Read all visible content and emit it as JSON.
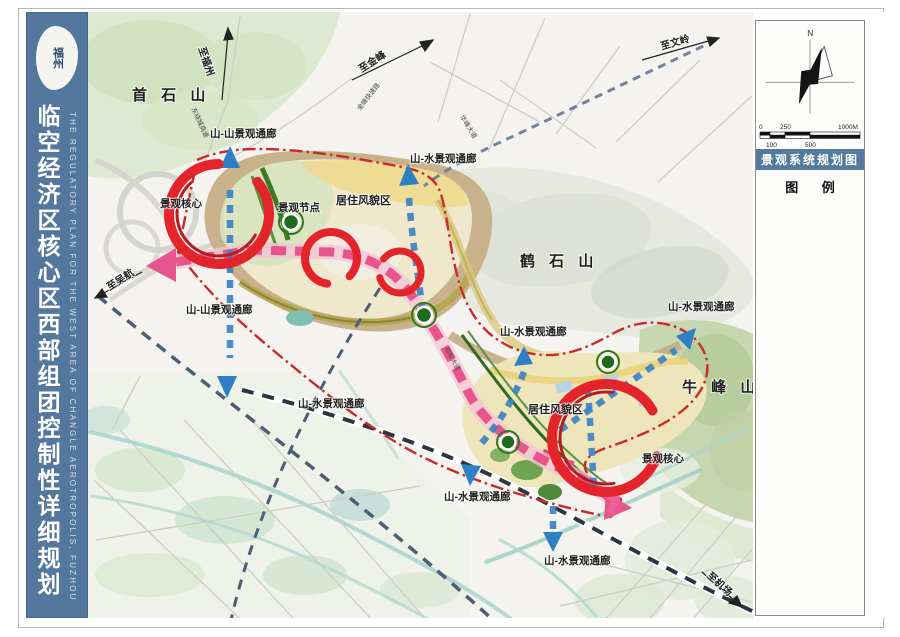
{
  "sidebar": {
    "accent": "#54779e",
    "title": "临空经济区核心区西部组团控制性详细规划",
    "subtitle_en": "THE REGULATORY PLAN FOR THE WEST AREA OF CHANGLE AEROTROPOLIS, FUZHOU",
    "seal_text": "福州"
  },
  "panel": {
    "north_label": "N",
    "map_title": "景观系统规划图",
    "legend_title": "图 例",
    "scale_ticks": {
      "t0": "0",
      "t100": "100",
      "t250": "250",
      "t500": "500",
      "t1000": "1000M"
    }
  },
  "map": {
    "mountains": {
      "shoushi": "首 石 山",
      "heshi": "鹤 石 山",
      "niufeng": "牛 峰 山"
    },
    "corridors": {
      "ss_top": "山-山景观通廊",
      "ss_mid": "山-山景观通廊",
      "sw_top": "山-水景观通廊",
      "sw_heshi": "山-水景观通廊",
      "sw_right": "山-水景观通廊",
      "sw_left": "山-水景观通廊",
      "sw_center": "山-水景观通廊",
      "sw_bottom": "山-水景观通廊"
    },
    "nodes": {
      "node_label": "景观节点",
      "core_nw": "景观核心",
      "core_se": "景观核心"
    },
    "areas": {
      "residential_nw": "居住风貌区",
      "residential_se": "居住风貌区"
    },
    "destinations": {
      "fuzhou": "至福州",
      "jinfeng": "至金峰",
      "wenling": "至文岭",
      "wuhang": "至吴航",
      "airport": "至机场"
    },
    "roads": {
      "raocheng": "东绕城高速",
      "jinfeng_rd": "金峰快速路",
      "huafeng": "华峰大道",
      "zhenghe": "郑和大道"
    },
    "colors": {
      "boundary": "#c92a2a",
      "axis_pink": "#e8548c",
      "corridor_blue": "#3c82c6",
      "node_green": "#1e6b1e",
      "swoosh_red": "#e3242b"
    }
  }
}
